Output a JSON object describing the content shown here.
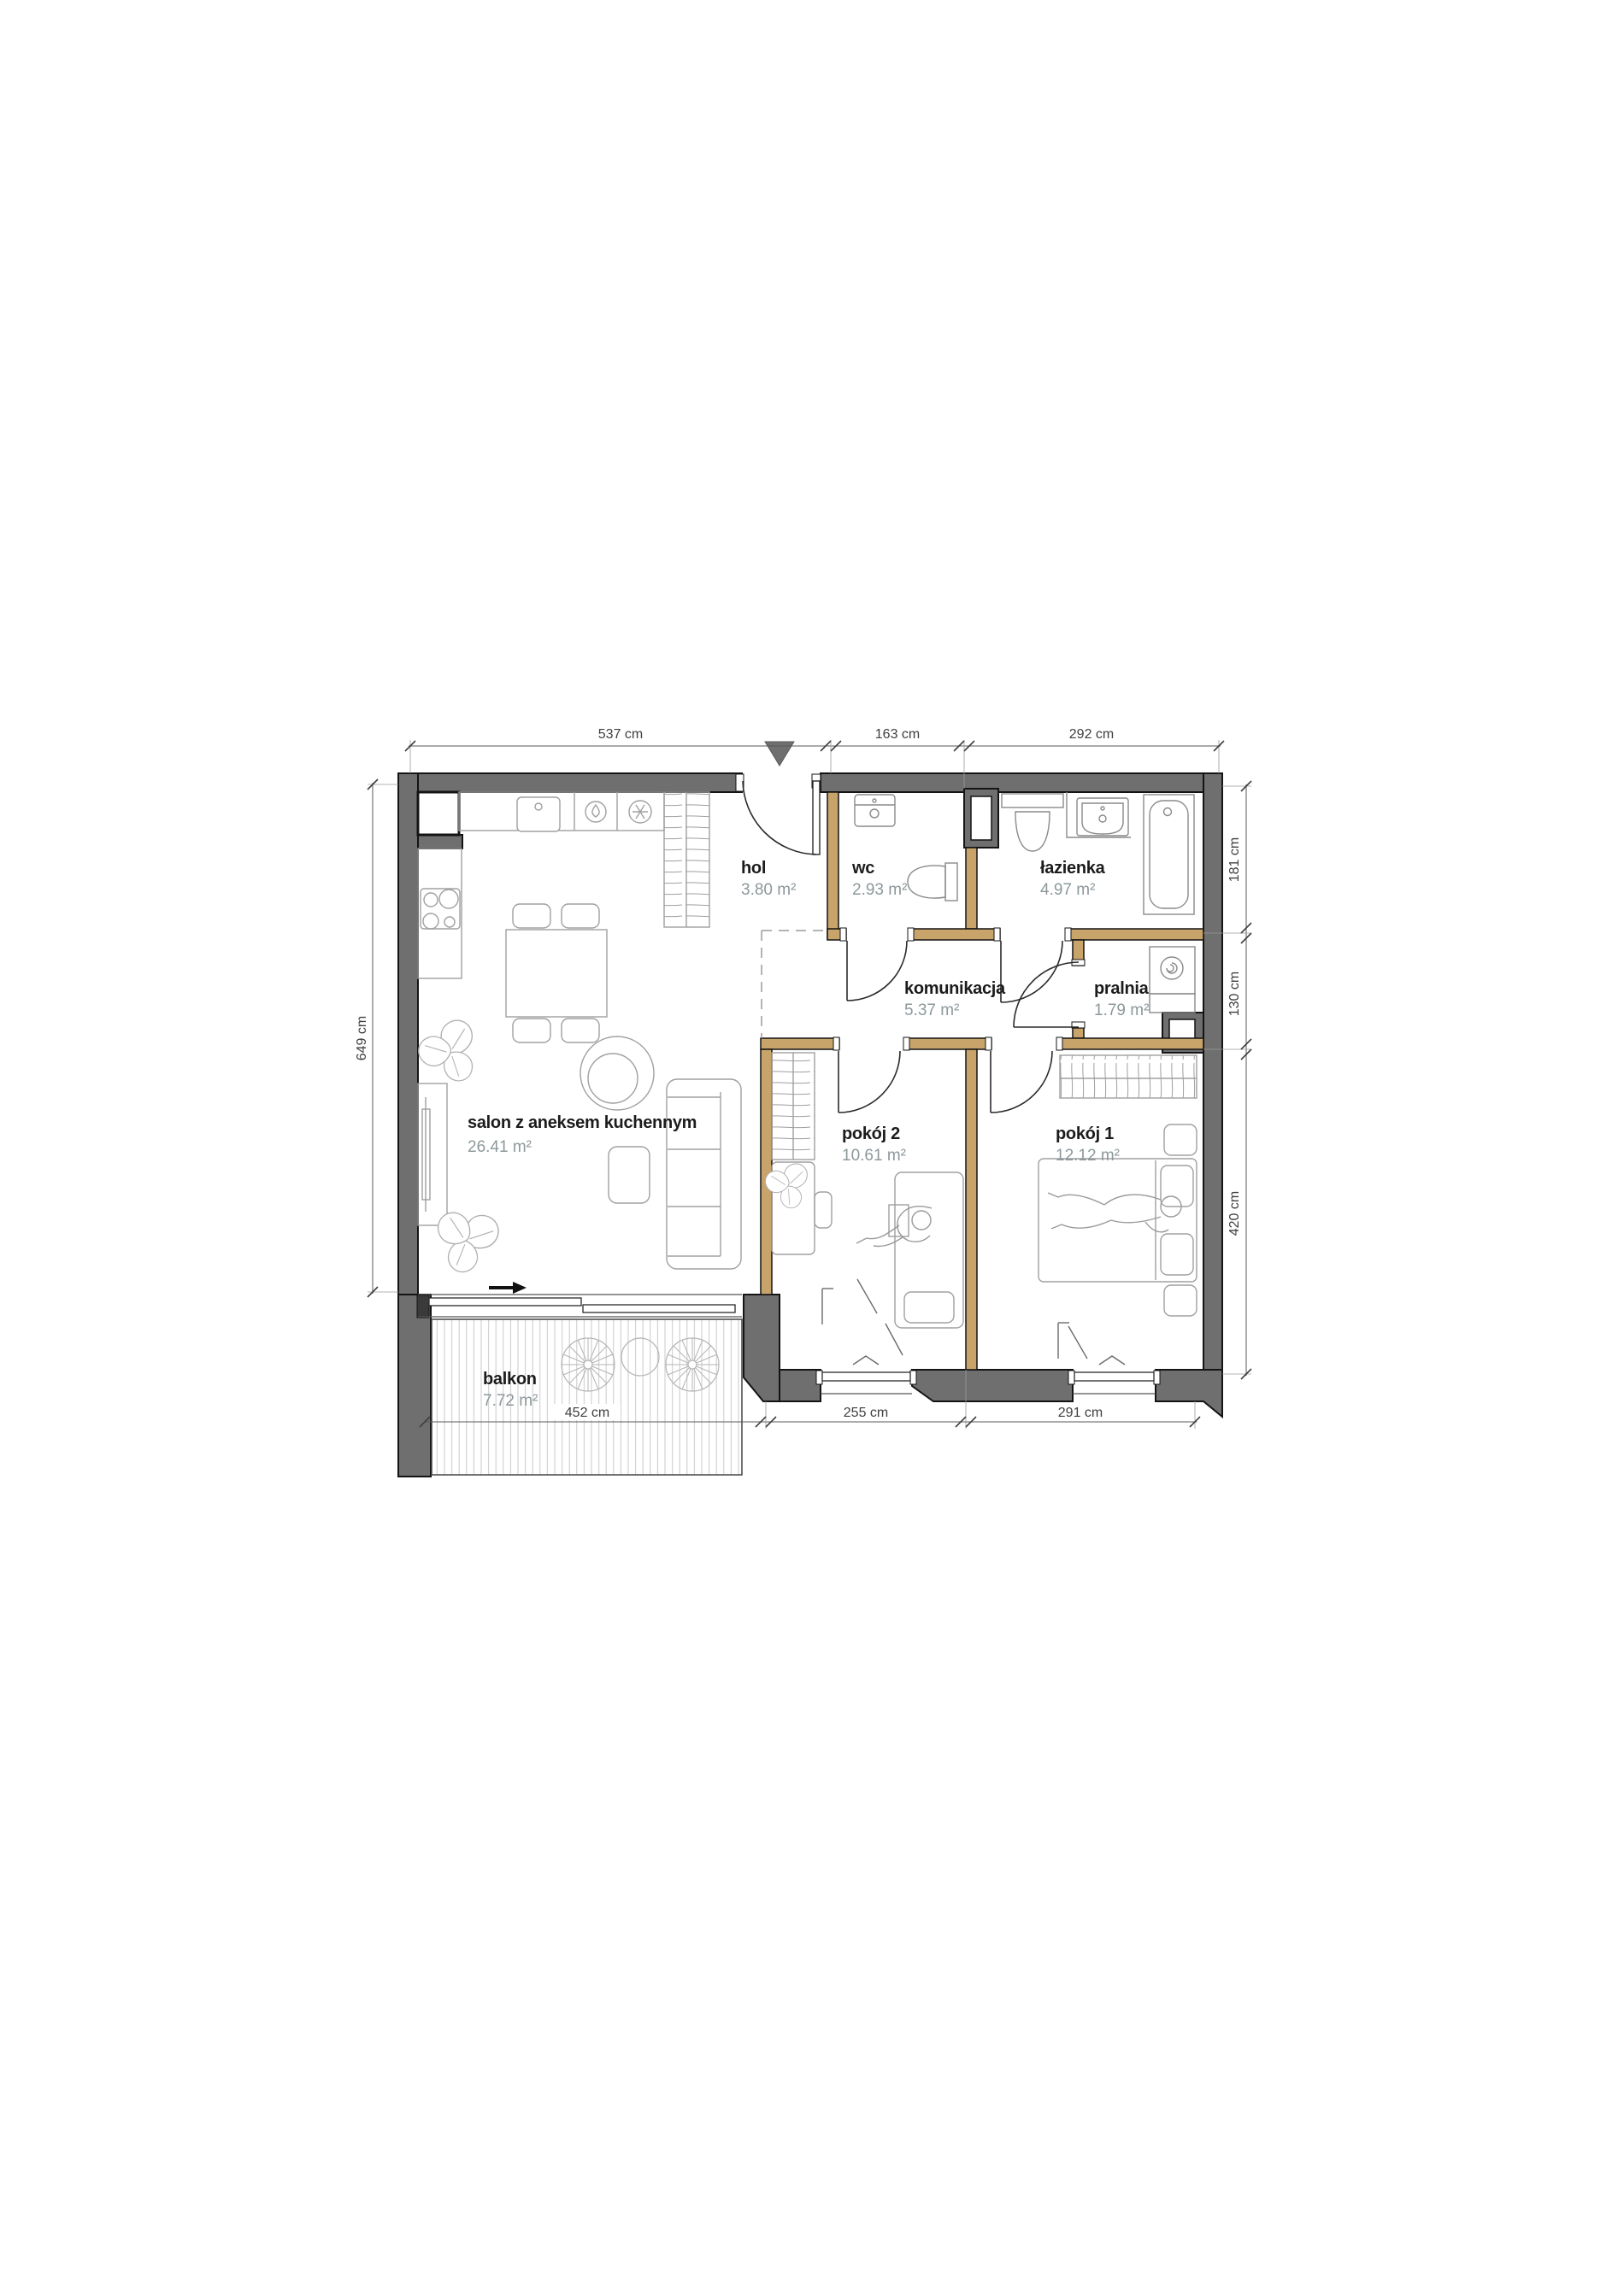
{
  "plan": {
    "colors": {
      "exterior_wall": "#6f6f6f",
      "interior_wall": "#c8a46b",
      "room_name_text": "#1c1c1c",
      "area_text": "#8d989b",
      "dimension_text": "#3f3f3f"
    },
    "rooms": {
      "hol": {
        "name": "hol",
        "area": "3.80 m²"
      },
      "wc": {
        "name": "wc",
        "area": "2.93 m²"
      },
      "lazienka": {
        "name": "łazienka",
        "area": "4.97 m²"
      },
      "komunikacja": {
        "name": "komunikacja",
        "area": "5.37 m²"
      },
      "pralnia": {
        "name": "pralnia",
        "area": "1.79 m²"
      },
      "salon": {
        "name": "salon z aneksem kuchennym",
        "area": "26.41 m²"
      },
      "pokoj2": {
        "name": "pokój 2",
        "area": "10.61 m²"
      },
      "pokoj1": {
        "name": "pokój 1",
        "area": "12.12 m²"
      },
      "balkon": {
        "name": "balkon",
        "area": "7.72 m²"
      }
    },
    "dimensions": {
      "top": [
        "537 cm",
        "163 cm",
        "292 cm"
      ],
      "left": [
        "649 cm"
      ],
      "right": [
        "181 cm",
        "130 cm",
        "420 cm"
      ],
      "bottom": [
        "452 cm",
        "255 cm",
        "291 cm"
      ]
    }
  }
}
